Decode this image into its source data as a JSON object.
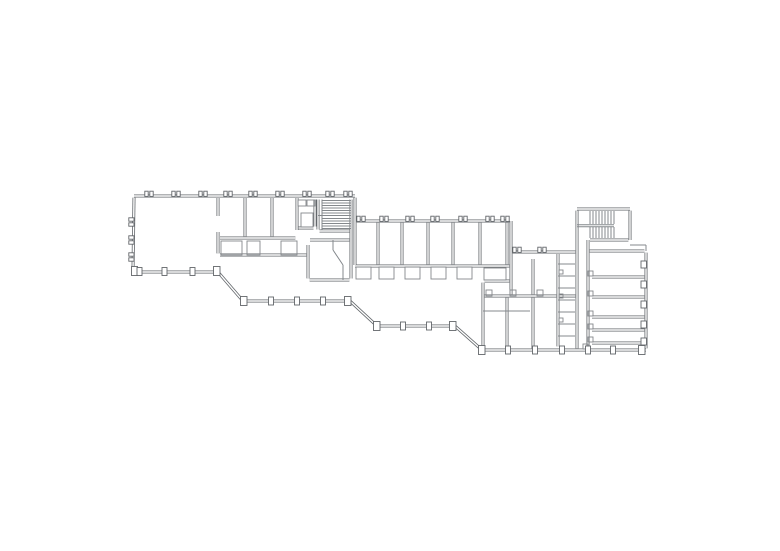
{
  "meta": {
    "background": "#ffffff",
    "line_color": "#63676b",
    "detail_color": "#84888c"
  },
  "plan": {
    "wall_outer": 3,
    "wall_inner": 1.4,
    "colors": {
      "wall": "#63676b",
      "detail": "#84888c",
      "paper": "#ffffff"
    },
    "double_walls": [
      [
        134,
        196,
        355,
        196
      ],
      [
        355,
        197.6,
        355,
        265
      ],
      [
        356.6,
        221,
        509.4,
        221
      ],
      [
        511,
        221,
        511,
        294.4
      ],
      [
        512.6,
        252,
        575.4,
        252
      ],
      [
        577,
        209,
        630,
        209
      ],
      [
        630,
        210.6,
        630,
        240
      ],
      [
        577,
        210.6,
        577,
        348.4
      ],
      [
        590,
        240,
        628.4,
        240
      ],
      [
        589.6,
        251,
        644.4,
        251
      ],
      [
        646,
        252.6,
        646,
        348.4
      ],
      [
        646,
        350,
        482,
        350
      ],
      [
        482,
        350,
        455,
        326
      ],
      [
        455,
        326,
        377,
        326
      ],
      [
        377,
        326,
        350,
        301
      ],
      [
        350,
        301,
        243,
        301
      ],
      [
        243,
        301,
        218,
        272
      ],
      [
        216.4,
        272,
        134.6,
        272
      ],
      [
        133,
        270.4,
        134,
        197.6
      ],
      [
        218,
        198,
        218,
        216
      ],
      [
        218,
        232,
        218,
        253.4
      ],
      [
        245,
        198,
        245,
        236.4
      ],
      [
        272,
        198,
        272,
        236.4
      ],
      [
        297,
        198,
        297,
        230
      ],
      [
        220,
        238,
        295.4,
        238
      ],
      [
        220,
        255,
        306.4,
        255
      ],
      [
        315,
        199.5,
        315,
        226.5
      ],
      [
        298.5,
        228,
        313.5,
        228
      ],
      [
        318,
        199.5,
        318,
        229.5
      ],
      [
        351,
        199.5,
        351,
        278.5
      ],
      [
        319.5,
        231,
        349.5,
        231
      ],
      [
        310,
        240,
        349.4,
        240
      ],
      [
        308,
        245,
        308,
        278.4
      ],
      [
        309.6,
        280,
        349.4,
        280
      ],
      [
        378,
        222.6,
        378,
        264.4
      ],
      [
        402,
        222.6,
        402,
        264.4
      ],
      [
        428,
        222.6,
        428,
        264.4
      ],
      [
        453,
        222.6,
        453,
        264.4
      ],
      [
        480,
        222.6,
        480,
        264.4
      ],
      [
        507,
        222.6,
        507,
        264.4
      ],
      [
        355,
        266,
        509.4,
        266
      ],
      [
        533,
        259,
        533,
        294.4
      ],
      [
        558,
        254,
        558,
        346.4
      ],
      [
        484.6,
        296,
        556.4,
        296
      ],
      [
        559.6,
        296,
        575.4,
        296
      ],
      [
        483,
        282.6,
        483,
        348.4
      ],
      [
        484.6,
        281,
        509.4,
        281
      ],
      [
        507,
        297.6,
        507,
        348.4
      ],
      [
        533,
        297.6,
        533,
        348.4
      ],
      [
        588,
        240,
        588,
        346.4
      ],
      [
        592,
        277,
        644.4,
        277
      ],
      [
        592,
        297,
        644.4,
        297
      ],
      [
        592,
        317,
        644.4,
        317
      ],
      [
        592,
        330,
        644.4,
        330
      ],
      [
        592,
        343,
        644.4,
        343
      ]
    ],
    "thin_lines": [
      [
        318,
        215.5,
        351,
        215.5
      ],
      [
        322,
        200.5,
        351,
        200.5
      ],
      [
        322,
        203,
        351,
        203
      ],
      [
        322,
        205.5,
        351,
        205.5
      ],
      [
        322,
        208,
        351,
        208
      ],
      [
        322,
        210.5,
        351,
        210.5
      ],
      [
        322,
        213,
        351,
        213
      ],
      [
        322,
        218.5,
        351,
        218.5
      ],
      [
        322,
        221,
        351,
        221
      ],
      [
        322,
        223.5,
        351,
        223.5
      ],
      [
        322,
        226,
        351,
        226
      ],
      [
        322,
        228.5,
        351,
        228.5
      ],
      [
        322,
        199.5,
        322,
        229.5
      ],
      [
        590,
        211,
        590,
        224
      ],
      [
        593,
        211,
        593,
        224
      ],
      [
        596,
        211,
        596,
        224
      ],
      [
        599,
        211,
        599,
        224
      ],
      [
        602,
        211,
        602,
        224
      ],
      [
        605,
        211,
        605,
        224
      ],
      [
        608,
        211,
        608,
        224
      ],
      [
        611,
        211,
        611,
        224
      ],
      [
        614,
        211,
        614,
        224
      ],
      [
        590,
        227,
        590,
        238
      ],
      [
        593,
        227,
        593,
        238
      ],
      [
        596,
        227,
        596,
        238
      ],
      [
        599,
        227,
        599,
        238
      ],
      [
        602,
        227,
        602,
        238
      ],
      [
        605,
        227,
        605,
        238
      ],
      [
        608,
        227,
        608,
        238
      ],
      [
        611,
        227,
        611,
        238
      ],
      [
        614,
        227,
        614,
        238
      ],
      [
        577,
        224.7,
        614,
        224.7
      ],
      [
        577,
        226.7,
        614,
        226.7
      ],
      [
        558,
        264,
        575,
        264
      ],
      [
        558,
        276,
        575,
        276
      ],
      [
        558,
        288,
        575,
        288
      ],
      [
        558,
        300,
        575,
        300
      ],
      [
        558,
        312,
        575,
        312
      ],
      [
        558,
        324,
        575,
        324
      ],
      [
        558,
        336,
        575,
        336
      ],
      [
        333,
        240,
        333,
        250
      ],
      [
        333,
        250,
        343,
        265
      ],
      [
        343,
        265,
        343,
        280
      ],
      [
        630,
        245,
        646,
        245
      ],
      [
        646,
        245,
        646,
        251
      ],
      [
        483,
        311,
        530,
        311
      ]
    ],
    "boxes": [
      [
        301,
        213,
        12,
        14
      ],
      [
        298,
        200,
        8,
        6
      ],
      [
        307,
        200,
        8,
        6
      ],
      [
        221,
        241,
        21,
        14
      ],
      [
        247,
        241,
        13,
        14
      ],
      [
        281,
        241,
        16,
        14
      ],
      [
        356,
        267,
        15,
        12
      ],
      [
        379,
        267,
        15,
        12
      ],
      [
        405,
        267,
        15,
        12
      ],
      [
        431,
        267,
        15,
        12
      ],
      [
        457,
        267,
        15,
        12
      ],
      [
        484,
        268,
        22,
        12
      ],
      [
        588,
        271,
        5,
        5
      ],
      [
        588,
        291,
        5,
        5
      ],
      [
        588,
        311,
        5,
        5
      ],
      [
        588,
        324,
        5,
        5
      ],
      [
        588,
        337,
        5,
        5
      ],
      [
        486,
        290,
        6,
        6
      ],
      [
        510,
        290,
        6,
        6
      ],
      [
        537,
        290,
        6,
        6
      ],
      [
        559,
        270,
        4,
        4
      ],
      [
        559,
        294,
        4,
        4
      ],
      [
        559,
        318,
        4,
        4
      ],
      [
        583,
        344,
        5,
        5
      ]
    ],
    "columns": [
      [
        131.5,
        266.5,
        6,
        9
      ],
      [
        137,
        267.5,
        5,
        8
      ],
      [
        162,
        267.5,
        5,
        8
      ],
      [
        190,
        267.5,
        5,
        8
      ],
      [
        213.5,
        266.5,
        6.5,
        9
      ],
      [
        240.5,
        296.5,
        6.5,
        9
      ],
      [
        268.5,
        297,
        5,
        8
      ],
      [
        294.5,
        297,
        5,
        8
      ],
      [
        320.5,
        297,
        5,
        8
      ],
      [
        344.5,
        296.5,
        6.5,
        9
      ],
      [
        373.5,
        321.5,
        6.5,
        9
      ],
      [
        400.5,
        322,
        5,
        8
      ],
      [
        426.5,
        322,
        5,
        8
      ],
      [
        449.5,
        321.5,
        6.5,
        9
      ],
      [
        478.5,
        345.5,
        6.5,
        9
      ],
      [
        505.5,
        346,
        5,
        8
      ],
      [
        532.5,
        346,
        5,
        8
      ],
      [
        559.5,
        346,
        5,
        8
      ],
      [
        585.5,
        346,
        5,
        8
      ],
      [
        610.5,
        346,
        5,
        8
      ],
      [
        638.5,
        345.5,
        6.5,
        9
      ],
      [
        641,
        261,
        5.5,
        7
      ],
      [
        641,
        281,
        5.5,
        7
      ],
      [
        641,
        301,
        5.5,
        7
      ],
      [
        641,
        321,
        5.5,
        7
      ],
      [
        641,
        338,
        5.5,
        7
      ]
    ],
    "mullions": [
      [
        144.8,
        191.2,
        3.4,
        5.2
      ],
      [
        149.8,
        191.2,
        3.4,
        5.2
      ],
      [
        171.8,
        191.2,
        3.4,
        5.2
      ],
      [
        176.8,
        191.2,
        3.4,
        5.2
      ],
      [
        198.8,
        191.2,
        3.4,
        5.2
      ],
      [
        203.8,
        191.2,
        3.4,
        5.2
      ],
      [
        223.8,
        191.2,
        3.4,
        5.2
      ],
      [
        228.8,
        191.2,
        3.4,
        5.2
      ],
      [
        248.8,
        191.2,
        3.4,
        5.2
      ],
      [
        253.8,
        191.2,
        3.4,
        5.2
      ],
      [
        275.8,
        191.2,
        3.4,
        5.2
      ],
      [
        280.8,
        191.2,
        3.4,
        5.2
      ],
      [
        302.8,
        191.2,
        3.4,
        5.2
      ],
      [
        307.8,
        191.2,
        3.4,
        5.2
      ],
      [
        325.8,
        191.2,
        3.4,
        5.2
      ],
      [
        330.8,
        191.2,
        3.4,
        5.2
      ],
      [
        343.8,
        191.2,
        3.4,
        5.2
      ],
      [
        348.8,
        191.2,
        3.4,
        5.2
      ],
      [
        356.8,
        216.2,
        3.4,
        5.2
      ],
      [
        361.8,
        216.2,
        3.4,
        5.2
      ],
      [
        379.8,
        216.2,
        3.4,
        5.2
      ],
      [
        384.8,
        216.2,
        3.4,
        5.2
      ],
      [
        405.8,
        216.2,
        3.4,
        5.2
      ],
      [
        410.8,
        216.2,
        3.4,
        5.2
      ],
      [
        430.8,
        216.2,
        3.4,
        5.2
      ],
      [
        435.8,
        216.2,
        3.4,
        5.2
      ],
      [
        458.8,
        216.2,
        3.4,
        5.2
      ],
      [
        463.8,
        216.2,
        3.4,
        5.2
      ],
      [
        485.8,
        216.2,
        3.4,
        5.2
      ],
      [
        490.8,
        216.2,
        3.4,
        5.2
      ],
      [
        500.8,
        216.2,
        3.4,
        5.2
      ],
      [
        505.8,
        216.2,
        3.4,
        5.2
      ],
      [
        512.8,
        247.2,
        3.4,
        5.2
      ],
      [
        517.8,
        247.2,
        3.4,
        5.2
      ],
      [
        537.8,
        247.2,
        3.4,
        5.2
      ],
      [
        542.8,
        247.2,
        3.4,
        5.2
      ],
      [
        128.8,
        217.8,
        5.2,
        3.4
      ],
      [
        128.8,
        222.8,
        5.2,
        3.4
      ],
      [
        128.8,
        235.8,
        5.2,
        3.4
      ],
      [
        128.8,
        240.8,
        5.2,
        3.4
      ],
      [
        128.8,
        252.8,
        5.2,
        3.4
      ],
      [
        128.8,
        257.8,
        5.2,
        3.4
      ]
    ]
  }
}
